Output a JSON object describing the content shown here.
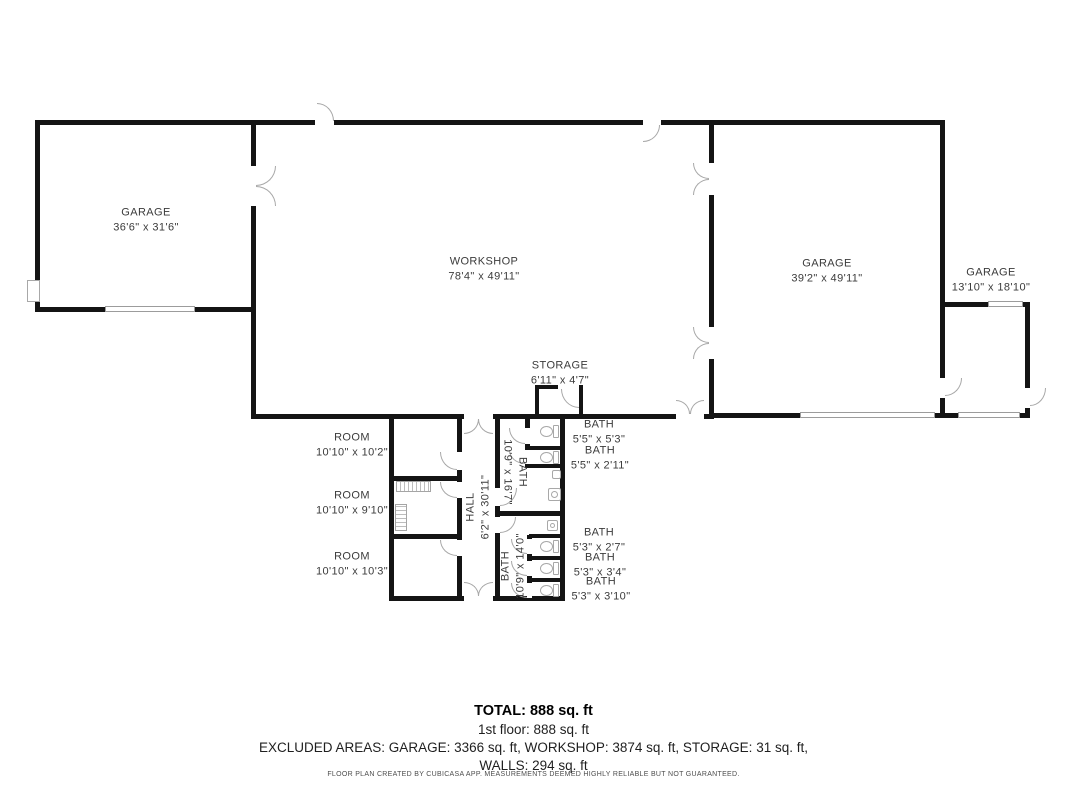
{
  "colors": {
    "wall": "#141414",
    "door_outline": "#a8a8a8",
    "label_text": "#3b3b3b"
  },
  "rooms": {
    "garage_left": {
      "name": "GARAGE",
      "dims": "36'6\" x 31'6\""
    },
    "workshop": {
      "name": "WORKSHOP",
      "dims": "78'4\" x 49'11\""
    },
    "garage_right": {
      "name": "GARAGE",
      "dims": "39'2\" x 49'11\""
    },
    "garage_small": {
      "name": "GARAGE",
      "dims": "13'10\" x 18'10\""
    },
    "storage": {
      "name": "STORAGE",
      "dims": "6'11\" x 4'7\""
    },
    "room_top": {
      "name": "ROOM",
      "dims": "10'10\" x 10'2\""
    },
    "room_middle": {
      "name": "ROOM",
      "dims": "10'10\" x 9'10\""
    },
    "room_bottom": {
      "name": "ROOM",
      "dims": "10'10\" x 10'3\""
    },
    "hall": {
      "name": "HALL",
      "dims": "6'2\" x 30'11\""
    },
    "bath_upper": {
      "name": "BATH",
      "dims": "10'9\" x 16'7\""
    },
    "bath_lower": {
      "name": "BATH",
      "dims": "10'9\" x 14'0\""
    },
    "bath_stall_1": {
      "name": "BATH",
      "dims": "5'5\" x 5'3\""
    },
    "bath_stall_2": {
      "name": "BATH",
      "dims": "5'5\" x 2'11\""
    },
    "bath_stall_3": {
      "name": "BATH",
      "dims": "5'3\" x 2'7\""
    },
    "bath_stall_4": {
      "name": "BATH",
      "dims": "5'3\" x 3'4\""
    },
    "bath_stall_5": {
      "name": "BATH",
      "dims": "5'3\" x 3'10\""
    }
  },
  "summary": {
    "total": "TOTAL: 888 sq. ft",
    "floor": "1st floor: 888 sq. ft",
    "excluded_line1": "EXCLUDED AREAS: GARAGE: 3366 sq. ft, WORKSHOP: 3874 sq. ft, STORAGE: 31 sq. ft,",
    "excluded_line2": "WALLS: 294 sq. ft"
  },
  "footer": {
    "disclaimer": "FLOOR PLAN CREATED BY CUBICASA APP. MEASUREMENTS DEEMED HIGHLY RELIABLE BUT NOT GUARANTEED."
  }
}
